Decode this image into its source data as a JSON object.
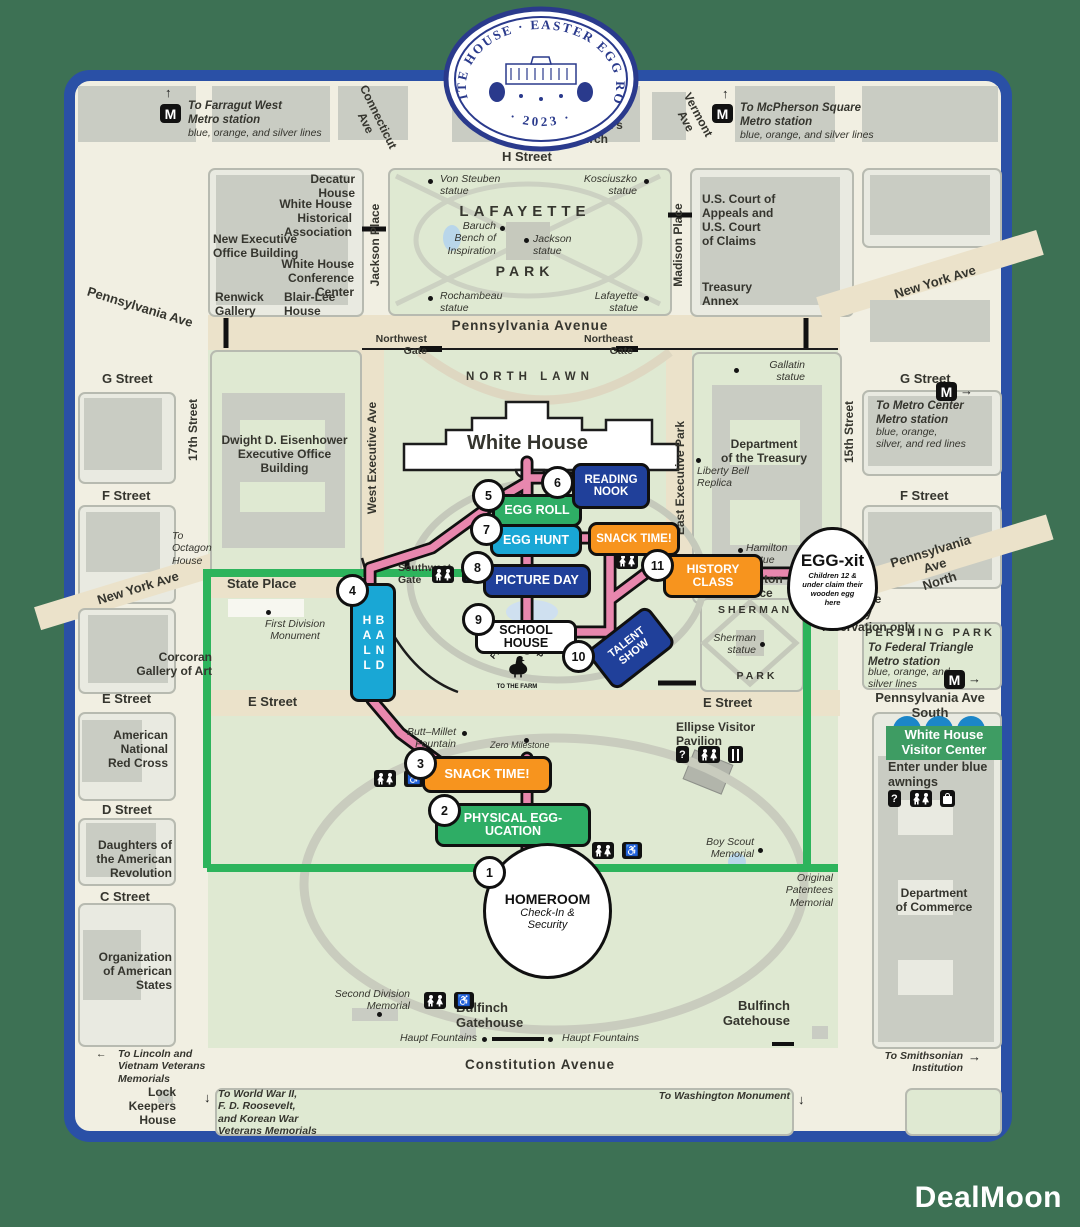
{
  "watermark": "DealMoon",
  "logo": {
    "arc": "WHITE HOUSE · EASTER EGG ROLL",
    "year": "· 2023 ·"
  },
  "icons": {
    "metro": "M",
    "info": "?",
    "accessible": "♿",
    "arrow_up": "↑",
    "arrow_down": "↓",
    "arrow_left": "←",
    "arrow_right": "→"
  },
  "colors": {
    "frame_blue": "#2a50a6",
    "board_green": "#3d7154",
    "route_pink": "#e887ae",
    "boundary_green": "#2db45c",
    "chip_green": "#2ead65",
    "chip_cyan": "#19a7d5",
    "chip_orange": "#f7941e",
    "chip_blue": "#20409a",
    "visitor_green": "#3e9c63"
  },
  "directions": {
    "farragut_title": "To Farragut West\nMetro station",
    "farragut_lines": "blue, orange, and silver lines",
    "mcpherson_title": "To McPherson Square\nMetro station",
    "mcpherson_lines": "blue, orange, and silver lines",
    "metro_center_title": "To Metro Center\nMetro station",
    "metro_center_lines": "blue, orange,\nsilver, and red lines",
    "federal_triangle_title": "To Federal Triangle\nMetro station",
    "federal_triangle_lines": "blue, orange, and\nsilver lines",
    "lincoln": "To Lincoln and\nVietnam Veterans\nMemorials",
    "ww2": "To World War II,\nF. D. Roosevelt,\nand Korean War\nVeterans Memorials",
    "washington": "To Washington Monument",
    "smithsonian": "To Smithsonian\nInstitution",
    "octagon": "To\nOctagon\nHouse",
    "enter_here": "Enter here\nTours by\nreservation only",
    "visitor_enter": "Enter under blue\nawnings"
  },
  "labels": {
    "h_street": "H Street",
    "penn_ave_nw": "Pennsylvania Ave",
    "connecticut": "Connecticut\nAve",
    "vermont": "Vermont\nAve",
    "veterans": "Department\nof Veterans\nAffairs",
    "st_johns": "St. John's\nChurch",
    "new_york_ne": "New York Ave",
    "decatur": "Decatur\nHouse",
    "whha": "White House\nHistorical\nAssociation",
    "neob": "New Executive\nOffice Building",
    "whcc": "White House\nConference\nCenter",
    "renwick": "Renwick\nGallery",
    "blair": "Blair-Lee\nHouse",
    "jackson_pl": "Jackson Place",
    "madison_pl": "Madison Place",
    "lafayette": "LAFAYETTE",
    "park": "PARK",
    "von_steuben": "Von Steuben\nstatue",
    "kosciuszko": "Kosciuszko\nstatue",
    "baruch": "Baruch\nBench of\nInspiration",
    "jackson_statue": "Jackson\nstatue",
    "rochambeau": "Rochambeau\nstatue",
    "lafayette_statue": "Lafayette\nstatue",
    "courts": "U.S. Court of\nAppeals and\nU.S. Court\nof Claims",
    "treasury_annex": "Treasury\nAnnex",
    "penn_avenue": "Pennsylvania  Avenue",
    "nw_gate": "Northwest\nGate",
    "ne_gate": "Northeast\nGate",
    "g_street_w": "G Street",
    "g_street_e": "G Street",
    "f_street_w": "F Street",
    "f_street_e": "F Street",
    "st17": "17th Street",
    "st15": "15th Street",
    "eisenhower": "Dwight D. Eisenhower\nExecutive Office\nBuilding",
    "west_exec": "West Executive Ave",
    "east_exec": "East Executive Park",
    "north_lawn": "NORTH LAWN",
    "white_house": "White House",
    "treasury": "Department\nof the Treasury",
    "gallatin": "Gallatin\nstatue",
    "liberty_bell": "Liberty Bell\nReplica",
    "hamilton_statue": "Hamilton\nstatue",
    "hamilton_pl": "Hamilton\nPlace",
    "new_york_w": "New York Ave",
    "state_pl": "State Place",
    "first_div": "First Division\nMonument",
    "sw_gate": "Southwest\nGate",
    "corcoran": "Corcoran\nGallery of Art",
    "e_street_w": "E Street",
    "e_street_m": "E Street",
    "e_street_e": "E Street",
    "sherman": "SHERMAN",
    "sherman_statue": "Sherman\nstatue",
    "sherman_park": "PARK",
    "penn_north": "Pennsylvania Ave\nNorth",
    "pershing": "PERSHING PARK",
    "penn_south": "Pennsylvania Ave\nSouth",
    "red_cross": "American\nNational\nRed Cross",
    "d_street": "D Street",
    "dar": "Daughters of\nthe American\nRevolution",
    "c_street": "C Street",
    "oas": "Organization\nof American\nStates",
    "butt_millet": "Butt–Millet\nFountain",
    "zero": "Zero Milestone",
    "pavilion": "Ellipse Visitor\nPavilion",
    "boy_scout": "Boy Scout\nMemorial",
    "patentees": "Original\nPatentees\nMemorial",
    "ellipse": "The Ellipse",
    "second_div": "Second Division\nMemorial",
    "haupt_w": "Haupt Fountains",
    "haupt_e": "Haupt Fountains",
    "bulfinch_w": "Bulfinch\nGatehouse",
    "bulfinch_e": "Bulfinch\nGatehouse",
    "constitution": "Constitution  Avenue",
    "lock": "Lock\nKeepers\nHouse",
    "visitor_center": "White House\nVisitor Center",
    "commerce": "Department\nof Commerce"
  },
  "stations": [
    {
      "num": "1",
      "name": "HOMEROOM",
      "sub": "Check-In &\nSecurity"
    },
    {
      "num": "2",
      "name": "PHYSICAL EGG-UCATION"
    },
    {
      "num": "3",
      "name": "SNACK TIME!"
    },
    {
      "num": "4",
      "name": "BAND HALL"
    },
    {
      "num": "5",
      "name": "EGG ROLL"
    },
    {
      "num": "6",
      "name": "READING\nNOOK"
    },
    {
      "num": "7",
      "name": "EGG HUNT"
    },
    {
      "num": "8",
      "name": "PICTURE DAY"
    },
    {
      "num": "9",
      "name": "SCHOOL HOUSE"
    },
    {
      "num": "10",
      "name": "TALENT\nSHOW"
    },
    {
      "num": "11",
      "name": "HISTORY\nCLASS"
    }
  ],
  "snack_station": {
    "name": "SNACK TIME!"
  },
  "egg_exit": {
    "name": "EGG-xit",
    "note": "Children 12 &\nunder claim their\nwooden egg\nhere"
  },
  "field_trip": {
    "top": "FIELD TRIP",
    "bottom": "TO THE FARM"
  }
}
